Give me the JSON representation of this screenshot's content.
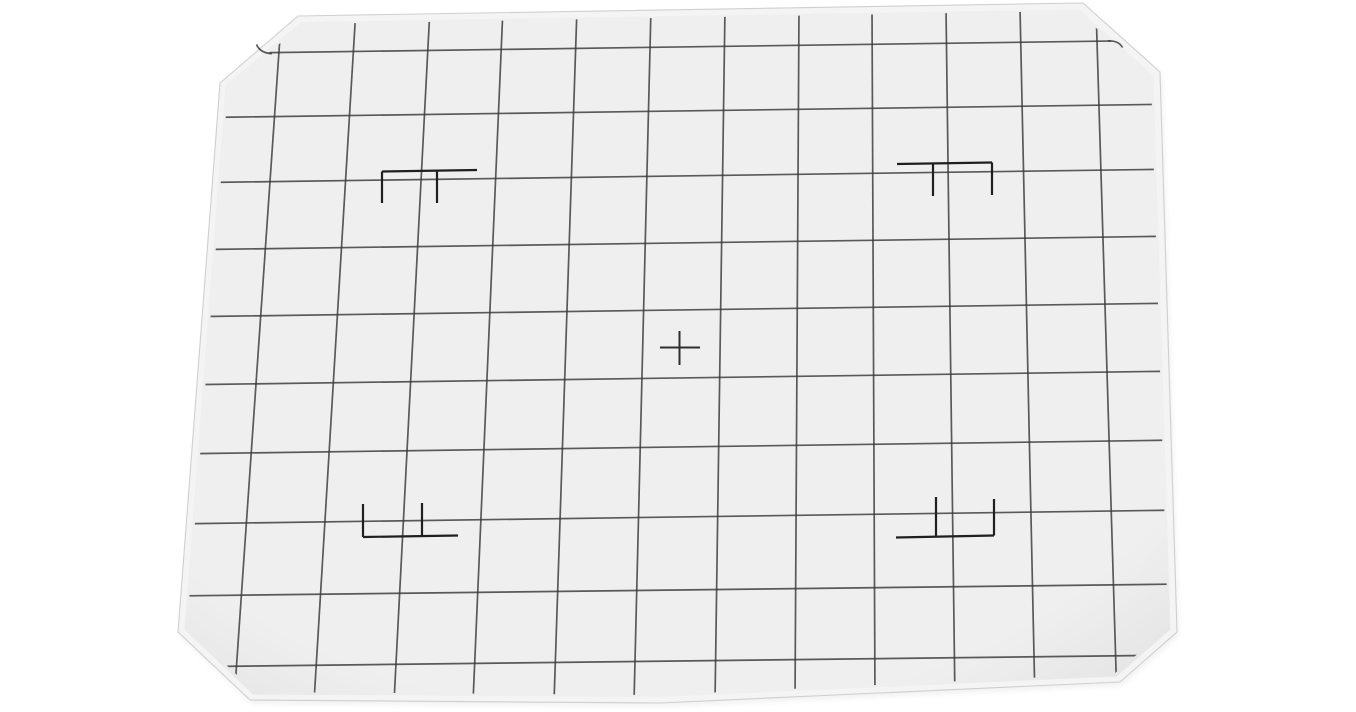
{
  "canvas": {
    "width": 1356,
    "height": 712,
    "background": "#ffffff"
  },
  "scene": {
    "subject": "camera focusing screen with ruled grid, center cross and four format marks"
  },
  "plate": {
    "outline_points": [
      [
        298,
        16
      ],
      [
        1083,
        3
      ],
      [
        1160,
        72
      ],
      [
        1177,
        632
      ],
      [
        1120,
        682
      ],
      [
        660,
        703
      ],
      [
        250,
        700
      ],
      [
        178,
        632
      ],
      [
        220,
        83
      ]
    ],
    "bevel_inner_points": [
      [
        301,
        22
      ],
      [
        1079,
        9.5
      ],
      [
        1153.5,
        75.5
      ],
      [
        1170.5,
        629.5
      ],
      [
        1116.5,
        676.5
      ],
      [
        660,
        697
      ],
      [
        253,
        694.5
      ],
      [
        184.5,
        629.5
      ],
      [
        225.5,
        85
      ]
    ],
    "grid_clip_points": [
      [
        303,
        24
      ],
      [
        1077,
        11
      ],
      [
        1151,
        77
      ],
      [
        1168,
        628
      ],
      [
        1114,
        674
      ],
      [
        660,
        695
      ],
      [
        255,
        692
      ],
      [
        187,
        628
      ],
      [
        228,
        87
      ]
    ],
    "bevel_fill": "#f4f4f4",
    "edge_stroke": "#c6c6c6",
    "fill_center": "#efefef",
    "fill_edge": "#e2e2e2",
    "shadow_color": "#000000",
    "shadow_opacity": 0.05
  },
  "grid": {
    "stroke": "#383838",
    "stroke_width": 1.7,
    "opacity": 0.82,
    "vertical_lines": [
      [
        282,
        8,
        234,
        702
      ],
      [
        356,
        8,
        314,
        702
      ],
      [
        430,
        8,
        394,
        702
      ],
      [
        503,
        8,
        473,
        702
      ],
      [
        577,
        8,
        554,
        702
      ],
      [
        651,
        8,
        634,
        702
      ],
      [
        725,
        8,
        715,
        702
      ],
      [
        799,
        8,
        795,
        702
      ],
      [
        872,
        8,
        875,
        702
      ],
      [
        946,
        8,
        955,
        702
      ],
      [
        1020,
        8,
        1035,
        702
      ],
      [
        1096,
        8,
        1117,
        702
      ]
    ],
    "horizontal_lines": [
      [
        170,
        54,
        1185,
        40
      ],
      [
        170,
        118,
        1185,
        104
      ],
      [
        170,
        183,
        1185,
        169
      ],
      [
        170,
        250,
        1185,
        236
      ],
      [
        170,
        317,
        1185,
        303
      ],
      [
        170,
        385,
        1185,
        371
      ],
      [
        170,
        454,
        1185,
        440
      ],
      [
        170,
        524,
        1185,
        510
      ],
      [
        170,
        596,
        1185,
        584
      ],
      [
        170,
        667,
        1185,
        655
      ]
    ],
    "edge_hook_paths": [
      "M 272 53.7 Q 260 53 256.5 44.5",
      "M 1108 40.8 Q 1119 40.6 1122.5 47.5"
    ]
  },
  "center_cross": {
    "stroke": "#2e2e2e",
    "stroke_width": 2,
    "lines": [
      [
        660,
        347.5,
        700,
        347.5
      ],
      [
        679.5,
        331,
        679.5,
        365
      ]
    ]
  },
  "format_marks": {
    "stroke": "#1f1f1f",
    "stroke_width": 2.2,
    "marks": [
      {
        "name": "format-mark-top-left",
        "lines": [
          [
            382,
            171.5,
            477,
            170
          ],
          [
            382,
            171.5,
            382,
            203
          ],
          [
            437,
            171,
            437,
            203
          ]
        ]
      },
      {
        "name": "format-mark-top-right",
        "lines": [
          [
            897,
            164,
            992,
            162.5
          ],
          [
            933,
            163.5,
            933,
            196
          ],
          [
            992,
            162.5,
            992,
            195
          ]
        ]
      },
      {
        "name": "format-mark-bottom-left",
        "lines": [
          [
            363,
            537,
            458,
            535.5
          ],
          [
            363,
            537,
            363,
            504
          ],
          [
            422,
            536.5,
            422,
            503
          ]
        ]
      },
      {
        "name": "format-mark-bottom-right",
        "lines": [
          [
            896,
            537.5,
            994,
            535.5
          ],
          [
            936,
            536.5,
            936,
            497
          ],
          [
            994,
            535.5,
            994,
            499
          ]
        ]
      }
    ]
  }
}
